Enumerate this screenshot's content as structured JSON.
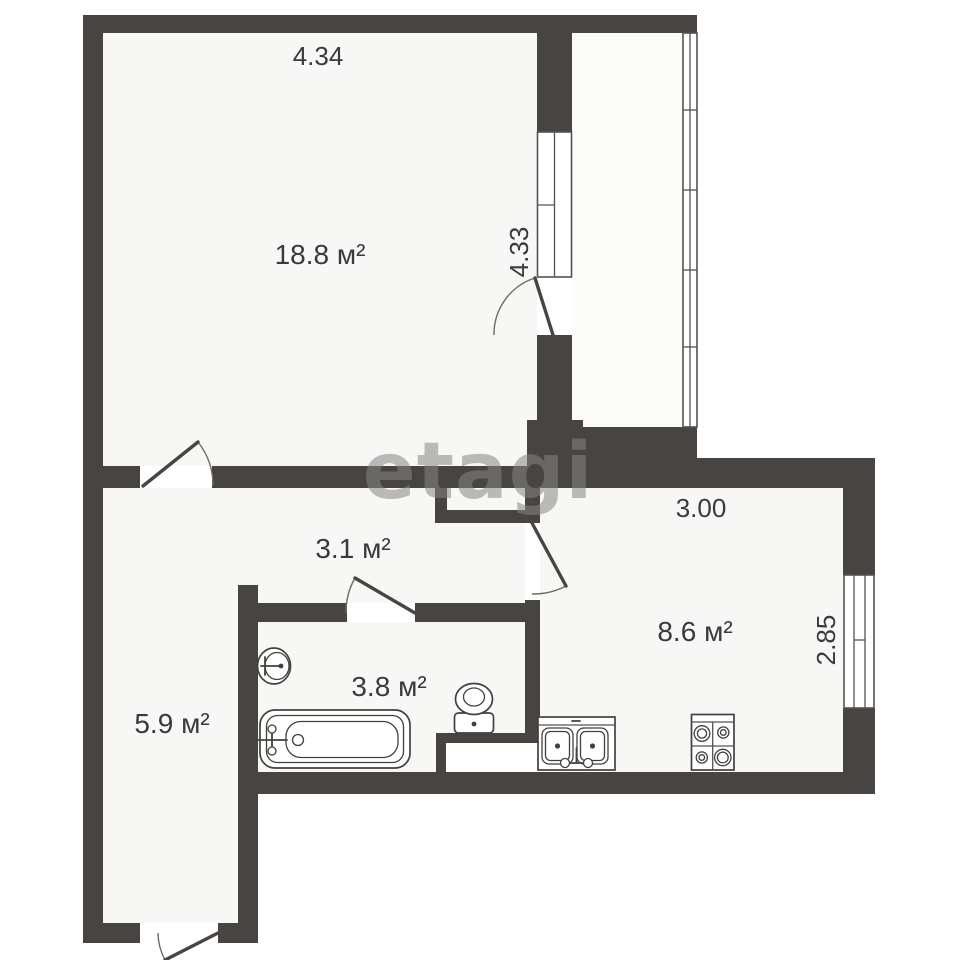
{
  "watermark": "etagi",
  "areas": {
    "living": "18.8 м²",
    "hallway": "3.1 м²",
    "kitchen": "8.6 м²",
    "bathroom": "3.8 м²",
    "entry": "5.9 м²"
  },
  "dimensions": {
    "living_width": "4.34",
    "balcony_height": "4.33",
    "kitchen_width": "3.00",
    "kitchen_depth": "2.85"
  },
  "colors": {
    "wall": "#484441",
    "label": "#3a3a3a",
    "watermark": "#878787",
    "fixture_stroke": "#44403d",
    "floor": "#f7f7f5"
  },
  "rooms": [
    "living",
    "hallway",
    "kitchen",
    "bathroom",
    "entry",
    "balcony"
  ],
  "fixtures": [
    "bathtub",
    "washbasin",
    "toilet",
    "kitchen-sink",
    "stove"
  ],
  "doors": [
    "living-room-door",
    "balcony-door",
    "kitchen-door",
    "bathroom-door",
    "entrance-door"
  ],
  "windows": [
    "balcony-block-window",
    "balcony-glazing",
    "kitchen-window"
  ]
}
